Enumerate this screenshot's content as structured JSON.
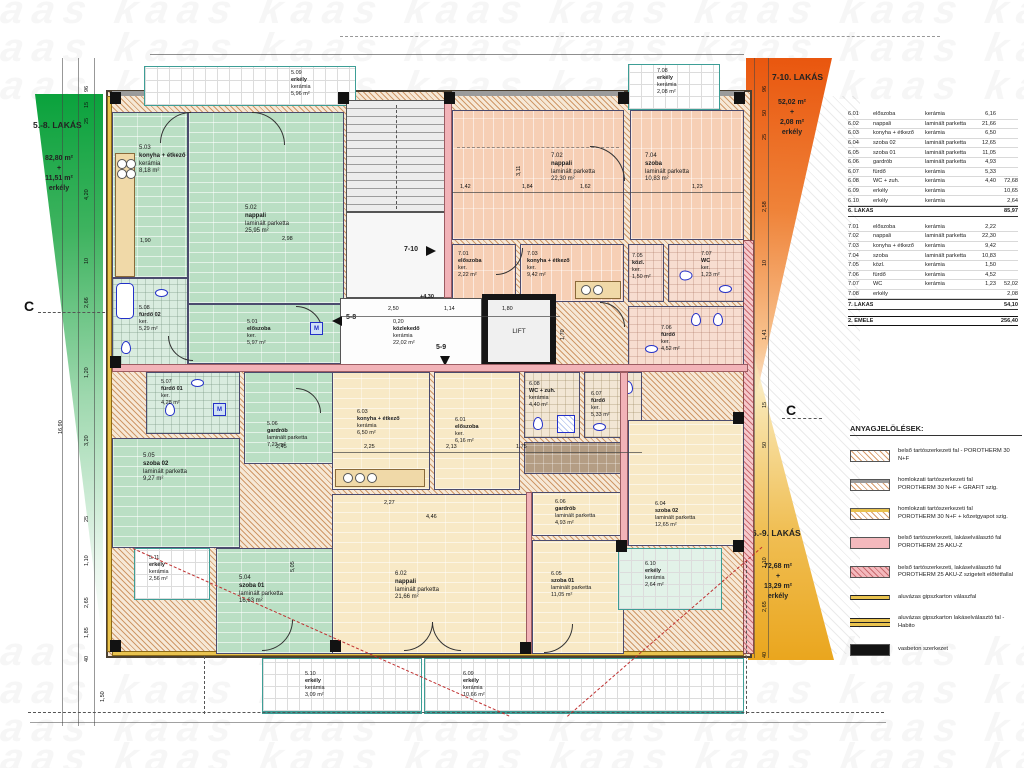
{
  "watermark": {
    "text": "kaas kaas kaas kaas kaas kaas kaas kaas kaas"
  },
  "zones": {
    "green": {
      "title": "5.-8. LAKÁS",
      "area": "82,80 m²",
      "plus": "+",
      "balcony_area": "11,51 m²",
      "balcony_label": "erkély"
    },
    "orange": {
      "title": "7-10. LAKÁS",
      "area": "52,02 m²",
      "plus": "+",
      "balcony_area": "2,08 m²",
      "balcony_label": "erkély"
    },
    "amber": {
      "title": "6.-9. LAKÁS",
      "area": "72,68 m²",
      "plus": "+",
      "balcony_area": "13,29 m²",
      "balcony_label": "erkély"
    }
  },
  "rooms": {
    "r501": {
      "num": "5.01",
      "name": "előszoba",
      "mat": "ker.",
      "area": "5,97 m²"
    },
    "r502": {
      "num": "5.02",
      "name": "nappali",
      "mat": "laminált parketta",
      "area": "25,95 m²"
    },
    "r503": {
      "num": "5.03",
      "name": "konyha + étkező",
      "mat": "kerámia",
      "area": "8,18 m²"
    },
    "r504": {
      "num": "5.04",
      "name": "szoba 01",
      "mat": "laminált parketta",
      "area": "16,63 m²"
    },
    "r505": {
      "num": "5.05",
      "name": "szoba 02",
      "mat": "laminált parketta",
      "area": "9,27 m²"
    },
    "r506": {
      "num": "5.06",
      "name": "gardrób",
      "mat": "laminált parketta",
      "area": "7,23 m²"
    },
    "r507": {
      "num": "5.07",
      "name": "fürdő 01",
      "mat": "ker.",
      "area": "4,28 m²"
    },
    "r508": {
      "num": "5.08",
      "name": "fürdő 02",
      "mat": "ker.",
      "area": "5,29 m²"
    },
    "r509": {
      "num": "5.09",
      "name": "erkély",
      "mat": "kerámia",
      "area": "5,96 m²"
    },
    "r510": {
      "num": "5.10",
      "name": "erkély",
      "mat": "kerámia",
      "area": "3,09 m²"
    },
    "r511": {
      "num": "5.11",
      "name": "erkély",
      "mat": "kerámia",
      "area": "2,56 m²"
    },
    "r601": {
      "num": "6.01",
      "name": "előszoba",
      "mat": "ker.",
      "area": "6,16 m²"
    },
    "r602": {
      "num": "6.02",
      "name": "nappali",
      "mat": "laminált parketta",
      "area": "21,66 m²"
    },
    "r603": {
      "num": "6.03",
      "name": "konyha + étkező",
      "mat": "kerámia",
      "area": "6,50 m²"
    },
    "r604": {
      "num": "6.04",
      "name": "szoba 02",
      "mat": "laminált parketta",
      "area": "12,65 m²"
    },
    "r605": {
      "num": "6.05",
      "name": "szoba 01",
      "mat": "laminált parketta",
      "area": "11,05 m²"
    },
    "r606": {
      "num": "6.06",
      "name": "gardrób",
      "mat": "laminált parketta",
      "area": "4,93 m²"
    },
    "r607": {
      "num": "6.07",
      "name": "fürdő",
      "mat": "ker.",
      "area": "5,33 m²"
    },
    "r608": {
      "num": "6.08",
      "name": "WC + zuh.",
      "mat": "kerámia",
      "area": "4,40 m²"
    },
    "r609": {
      "num": "6.09",
      "name": "erkély",
      "mat": "kerámia",
      "area": "10,66 m²"
    },
    "r610": {
      "num": "6.10",
      "name": "erkély",
      "mat": "kerámia",
      "area": "2,64 m²"
    },
    "r701": {
      "num": "7.01",
      "name": "előszoba",
      "mat": "ker.",
      "area": "2,22 m²"
    },
    "r702": {
      "num": "7.02",
      "name": "nappali",
      "mat": "laminált parketta",
      "area": "22,30 m²"
    },
    "r703": {
      "num": "7.03",
      "name": "konyha + étkező",
      "mat": "ker.",
      "area": "9,42 m²"
    },
    "r704": {
      "num": "7.04",
      "name": "szoba",
      "mat": "laminált parketta",
      "area": "10,83 m²"
    },
    "r705": {
      "num": "7.05",
      "name": "közl.",
      "mat": "ker.",
      "area": "1,50 m²"
    },
    "r706": {
      "num": "7.06",
      "name": "fürdő",
      "mat": "ker.",
      "area": "4,52 m²"
    },
    "r707": {
      "num": "7.07",
      "name": "WC",
      "mat": "ker.",
      "area": "1,23 m²"
    },
    "r708": {
      "num": "7.08",
      "name": "erkély",
      "mat": "kerámia",
      "area": "2,08 m²"
    }
  },
  "core": {
    "hall_name": "közlekedő",
    "hall_mat": "kerámia",
    "hall_area": "22,02 m²",
    "hall_t": "0,20",
    "lift": "LIFT",
    "stair_up": "7-10",
    "stair_a": "5-8",
    "stair_b": "5-9",
    "level": "+4,30",
    "section": "C",
    "m": "M"
  },
  "schedule": {
    "rows": [
      {
        "id": "6.01",
        "name": "előszoba",
        "mat": "kerámia",
        "a1": "6,16",
        "a2": ""
      },
      {
        "id": "6.02",
        "name": "nappali",
        "mat": "laminált parketta",
        "a1": "21,66",
        "a2": ""
      },
      {
        "id": "6.03",
        "name": "konyha + étkező",
        "mat": "kerámia",
        "a1": "6,50",
        "a2": ""
      },
      {
        "id": "6.04",
        "name": "szoba 02",
        "mat": "laminált parketta",
        "a1": "12,65",
        "a2": ""
      },
      {
        "id": "6.05",
        "name": "szoba 01",
        "mat": "laminált parketta",
        "a1": "11,05",
        "a2": ""
      },
      {
        "id": "6.06",
        "name": "gardrób",
        "mat": "laminált parketta",
        "a1": "4,93",
        "a2": ""
      },
      {
        "id": "6.07",
        "name": "fürdő",
        "mat": "kerámia",
        "a1": "5,33",
        "a2": ""
      },
      {
        "id": "6.08",
        "name": "WC + zuh.",
        "mat": "kerámia",
        "a1": "4,40",
        "a2": "72,68"
      },
      {
        "id": "6.09",
        "name": "erkély",
        "mat": "kerámia",
        "a1": "",
        "a2": "10,65"
      },
      {
        "id": "6.10",
        "name": "erkély",
        "mat": "kerámia",
        "a1": "",
        "a2": "2,64"
      },
      {
        "id": "6. LAKÁS",
        "name": "",
        "mat": "",
        "a1": "",
        "a2": "85,97",
        "cls": "total"
      },
      {
        "id": "",
        "name": "",
        "mat": "",
        "a1": "",
        "a2": "",
        "cls": "spacer"
      },
      {
        "id": "7.01",
        "name": "előszoba",
        "mat": "kerámia",
        "a1": "2,22",
        "a2": ""
      },
      {
        "id": "7.02",
        "name": "nappali",
        "mat": "laminált parketta",
        "a1": "22,30",
        "a2": ""
      },
      {
        "id": "7.03",
        "name": "konyha + étkező",
        "mat": "kerámia",
        "a1": "9,42",
        "a2": ""
      },
      {
        "id": "7.04",
        "name": "szoba",
        "mat": "laminált parketta",
        "a1": "10,83",
        "a2": ""
      },
      {
        "id": "7.05",
        "name": "közl.",
        "mat": "kerámia",
        "a1": "1,50",
        "a2": ""
      },
      {
        "id": "7.06",
        "name": "fürdő",
        "mat": "kerámia",
        "a1": "4,52",
        "a2": ""
      },
      {
        "id": "7.07",
        "name": "WC",
        "mat": "kerámia",
        "a1": "1,23",
        "a2": "52,02"
      },
      {
        "id": "7.08",
        "name": "erkély",
        "mat": "",
        "a1": "",
        "a2": "2,08"
      },
      {
        "id": "7. LAKÁS",
        "name": "",
        "mat": "",
        "a1": "",
        "a2": "54,10",
        "cls": "total"
      },
      {
        "id": "",
        "name": "",
        "mat": "",
        "a1": "",
        "a2": "",
        "cls": "spacer"
      },
      {
        "id": "2. EMELET ÖSSZESEN",
        "name": "",
        "mat": "",
        "a1": "",
        "a2": "256,40",
        "cls": "grand"
      }
    ]
  },
  "legend": {
    "title": "ANYAGJELÖLÉSEK:",
    "items": [
      {
        "cls": "sw-hatch",
        "l1": "belső tartószerkezeti fal - POROTHERM 30 N+F",
        "l2": ""
      },
      {
        "cls": "sw-hatch-gray",
        "l1": "homlokzati tartószerkezeti fal",
        "l2": "POROTHERM 30 N+F + GRAFIT szig."
      },
      {
        "cls": "sw-hatch-yellow",
        "l1": "homlokzati tartószerkezeti fal",
        "l2": "POROTHERM 30 N+F + kőzetgyapot szig."
      },
      {
        "cls": "sw-pink",
        "l1": "belső tartószerkezeti, lakáselválasztó fal",
        "l2": "POROTHERM 25 AKU-Z"
      },
      {
        "cls": "sw-pink-hatch",
        "l1": "belső tartószerkezeti, lakáselválasztó fal",
        "l2": "POROTHERM 25 AKU-Z szigetelt előtétfallal"
      },
      {
        "cls": "sw-line-thin",
        "l1": "aluvázas gipszkarton válaszfal",
        "l2": ""
      },
      {
        "cls": "sw-line-double",
        "l1": "aluvázas gipszkarton lakáselválasztó fal - Habito",
        "l2": ""
      },
      {
        "cls": "sw-black",
        "l1": "vasbeton szerkezet",
        "l2": ""
      }
    ]
  },
  "dims": {
    "outer_left": "16,90",
    "left": [
      "96",
      "15",
      "25",
      "4,20",
      "10",
      "2,66",
      "1,20",
      "3,20",
      "25",
      "1,10",
      "2,65",
      "1,85",
      "40"
    ],
    "right": [
      "96",
      "50",
      "25",
      "2,58",
      "10",
      "1,41",
      "15",
      "50",
      "1,10",
      "2,65",
      "40"
    ],
    "bottom": [
      "1,50"
    ],
    "plan": {
      "p1": "2,50",
      "p2": "1,14",
      "p3": "1,80",
      "p4": "1,70",
      "p5": "4,46",
      "p6": "2,27",
      "p7": "1,90",
      "p8": "2,45",
      "p9": "2,98",
      "p10": "3,11",
      "p11": "1,42",
      "p12": "1,84",
      "p13": "1,62",
      "p14": "1,23",
      "p15": "5,05",
      "p16": "2,13",
      "p17": "2,25",
      "p18": "1,75"
    }
  }
}
